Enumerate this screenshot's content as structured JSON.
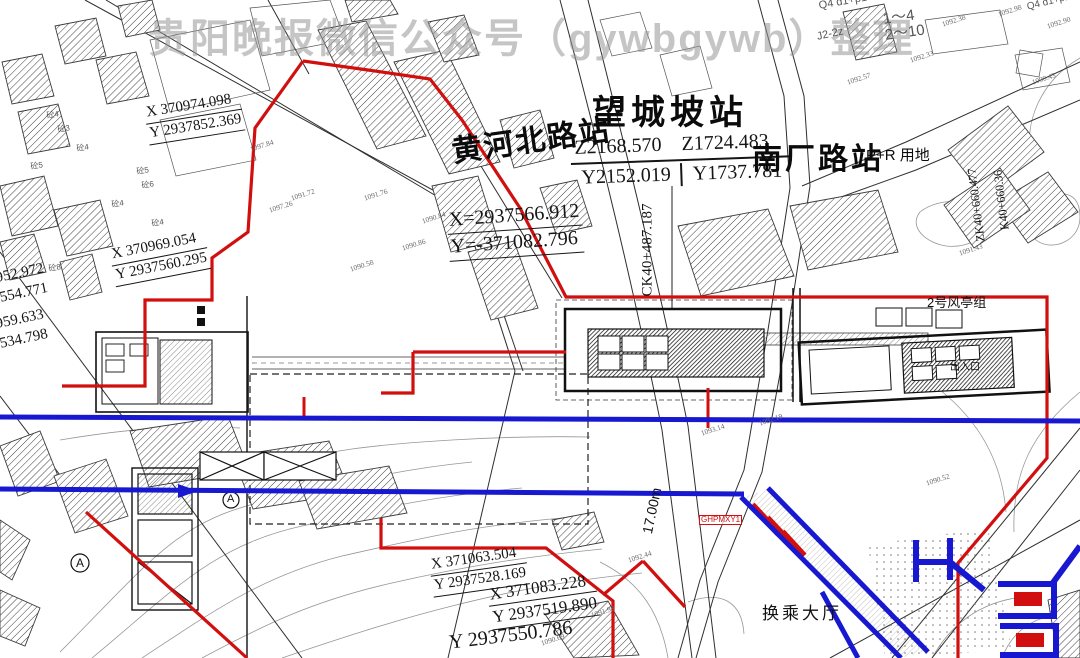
{
  "watermark": {
    "text": "贵阳晚报微信公众号（gywbgywb）整理",
    "color": "#969696"
  },
  "colors": {
    "boundary_red": "#d10f0f",
    "metro_blue": "#1718cf",
    "hatch": "#3c3c3c",
    "contour": "#969696"
  },
  "stations": {
    "wangchengpo": {
      "name": "望城坡站",
      "coord_row1": [
        "Z2168.570",
        "Z1724.483"
      ],
      "coord_row2": [
        "Y2152.019",
        "Y1737.781"
      ]
    },
    "huanghebei": {
      "name": "黄河北路站"
    },
    "nanchang": {
      "name": "南厂路站",
      "tag": "P+R 用地"
    }
  },
  "coord_blocks": [
    {
      "lines": [
        "X 370974.098",
        "Y 2937852.369"
      ],
      "x": 143,
      "y": 104,
      "r": -9,
      "s": 15,
      "u": true
    },
    {
      "lines": [
        "X=2937566.912",
        "Y=-371082.796"
      ],
      "x": 446,
      "y": 208,
      "r": -4,
      "s": 20,
      "u": true
    },
    {
      "lines": [
        "X 370969.054",
        "Y 2937560.295"
      ],
      "x": 108,
      "y": 246,
      "r": -11,
      "s": 15,
      "u": true
    },
    {
      "lines": [
        "952.972",
        "554.771"
      ],
      "x": -8,
      "y": 270,
      "r": -12,
      "s": 15,
      "u": false
    },
    {
      "lines": [
        "959.633",
        "534.798"
      ],
      "x": -8,
      "y": 316,
      "r": -12,
      "s": 15,
      "u": false
    },
    {
      "lines": [
        "X 371063.504",
        "Y 2937528.169"
      ],
      "x": 428,
      "y": 556,
      "r": -8,
      "s": 15,
      "u": true
    },
    {
      "lines": [
        "X 371083.228",
        "Y 2937519.890"
      ],
      "x": 486,
      "y": 584,
      "r": -8,
      "s": 17,
      "u": true
    },
    {
      "lines": [
        "Y 2937550.786"
      ],
      "x": 446,
      "y": 631,
      "r": -7,
      "s": 20,
      "u": false
    }
  ],
  "chainages": [
    {
      "t": "CK40+487.187",
      "x": 648,
      "y": 250,
      "r": -90,
      "s": 15
    },
    {
      "t": "ZK40+660.477",
      "x": 976,
      "y": 205,
      "r": -97,
      "s": 12
    },
    {
      "t": "K40+660.36",
      "x": 1001,
      "y": 200,
      "r": -97,
      "s": 12
    }
  ],
  "labels": [
    {
      "t": "2号风亭组",
      "x": 927,
      "y": 296,
      "s": 13
    },
    {
      "t": "换乘大厅",
      "x": 762,
      "y": 605,
      "s": 17,
      "ls": 3
    },
    {
      "t": "17.00m",
      "x": 640,
      "y": 532,
      "s": 14,
      "r": -78
    },
    {
      "t": "出入口",
      "x": 950,
      "y": 363,
      "s": 10
    },
    {
      "t": "GHPMXY1",
      "x": 699,
      "y": 515,
      "s": 8,
      "c": "#d10f0f",
      "box": true
    },
    {
      "t": "Q4 d1+p1",
      "x": 818,
      "y": 1,
      "s": 11,
      "r": -10,
      "c": "#555555"
    },
    {
      "t": "1～4",
      "x": 882,
      "y": 12,
      "s": 15,
      "r": -8,
      "c": "#555555"
    },
    {
      "t": "2～10",
      "x": 884,
      "y": 28,
      "s": 15,
      "r": -8,
      "c": "#555555"
    },
    {
      "t": "J2-2z",
      "x": 816,
      "y": 32,
      "s": 11,
      "r": -12,
      "c": "#555555"
    },
    {
      "t": "Q4 d1+p1",
      "x": 1026,
      "y": 3,
      "s": 10,
      "r": -14,
      "c": "#555555"
    },
    {
      "t": "A",
      "x": 76,
      "y": 557,
      "s": 12
    },
    {
      "t": "A",
      "x": 227,
      "y": 494,
      "s": 11
    }
  ],
  "spot_elevations": [
    {
      "t": "1092.98",
      "x": 997,
      "y": 11
    },
    {
      "t": "1092.38",
      "x": 941,
      "y": 21
    },
    {
      "t": "1092.33",
      "x": 909,
      "y": 57
    },
    {
      "t": "1090.43",
      "x": 1031,
      "y": 79
    },
    {
      "t": "1092.57",
      "x": 846,
      "y": 79
    },
    {
      "t": "1092.90",
      "x": 1046,
      "y": 23
    },
    {
      "t": "1097.84",
      "x": 249,
      "y": 146
    },
    {
      "t": "1091.72",
      "x": 290,
      "y": 195
    },
    {
      "t": "1097.26",
      "x": 268,
      "y": 207
    },
    {
      "t": "1091.76",
      "x": 363,
      "y": 195
    },
    {
      "t": "1090.84",
      "x": 421,
      "y": 218
    },
    {
      "t": "1090.86",
      "x": 401,
      "y": 245
    },
    {
      "t": "1090.58",
      "x": 349,
      "y": 266
    },
    {
      "t": "1093.14",
      "x": 700,
      "y": 430
    },
    {
      "t": "1092.44",
      "x": 627,
      "y": 557
    },
    {
      "t": "1091.98",
      "x": 590,
      "y": 612
    },
    {
      "t": "1090.69",
      "x": 540,
      "y": 640
    },
    {
      "t": "1092.19",
      "x": 758,
      "y": 420
    },
    {
      "t": "1091.43",
      "x": 958,
      "y": 250
    },
    {
      "t": "1090.52",
      "x": 925,
      "y": 480
    }
  ],
  "parcel_marks": [
    {
      "t": "砼4",
      "x": 46,
      "y": 112
    },
    {
      "t": "砼3",
      "x": 57,
      "y": 126
    },
    {
      "t": "砼5",
      "x": 30,
      "y": 163
    },
    {
      "t": "砼4",
      "x": 76,
      "y": 145
    },
    {
      "t": "砼5",
      "x": 136,
      "y": 168
    },
    {
      "t": "砼6",
      "x": 141,
      "y": 182
    },
    {
      "t": "砼4",
      "x": 111,
      "y": 201
    },
    {
      "t": "砼8",
      "x": 48,
      "y": 265
    },
    {
      "t": "砼4",
      "x": 151,
      "y": 220
    }
  ]
}
